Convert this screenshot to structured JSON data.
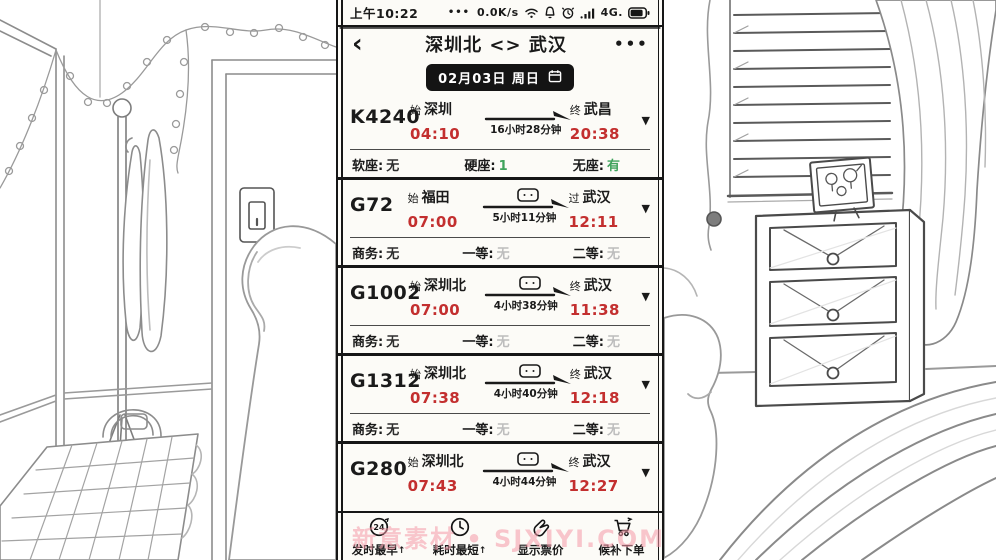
{
  "colors": {
    "ink": "#1a1a1a",
    "time_red": "#c32f2f",
    "available_green": "#3fa35c",
    "unavailable_gray": "#bdbdbd",
    "pill_black": "#141414",
    "watermark_pink": "#f59aa8"
  },
  "status_bar": {
    "time": "上午10:22",
    "dots": "•••",
    "net_speed": "0.0K/s",
    "icons": [
      "wifi",
      "bell",
      "alarm-clock",
      "signal-bars"
    ],
    "network": "4G.",
    "battery_icon": "battery"
  },
  "header": {
    "back_icon": "‹",
    "title": "深圳北 <> 武汉",
    "menu_icon": "•••"
  },
  "date_bar": {
    "date": "02月03日 周日",
    "calendar_icon": "calendar"
  },
  "trains": [
    {
      "code": "K4240",
      "from_tag": "始",
      "from": "深圳",
      "depart": "04:10",
      "duration": "16小时28分钟",
      "badge": false,
      "to_tag": "终",
      "to": "武昌",
      "arrive": "20:38",
      "seats": [
        {
          "label": "软座:",
          "value": "无",
          "color": "dark"
        },
        {
          "label": "硬座:",
          "value": "1",
          "color": "green"
        },
        {
          "label": "无座:",
          "value": "有",
          "color": "green"
        }
      ]
    },
    {
      "code": "G72",
      "from_tag": "始",
      "from": "福田",
      "depart": "07:00",
      "duration": "5小时11分钟",
      "badge": true,
      "to_tag": "过",
      "to": "武汉",
      "arrive": "12:11",
      "seats": [
        {
          "label": "商务:",
          "value": "无",
          "color": "dark"
        },
        {
          "label": "一等:",
          "value": "无",
          "color": "gray"
        },
        {
          "label": "二等:",
          "value": "无",
          "color": "gray"
        }
      ]
    },
    {
      "code": "G1002",
      "from_tag": "始",
      "from": "深圳北",
      "depart": "07:00",
      "duration": "4小时38分钟",
      "badge": true,
      "to_tag": "终",
      "to": "武汉",
      "arrive": "11:38",
      "seats": [
        {
          "label": "商务:",
          "value": "无",
          "color": "dark"
        },
        {
          "label": "一等:",
          "value": "无",
          "color": "gray"
        },
        {
          "label": "二等:",
          "value": "无",
          "color": "gray"
        }
      ]
    },
    {
      "code": "G1312",
      "from_tag": "始",
      "from": "深圳北",
      "depart": "07:38",
      "duration": "4小时40分钟",
      "badge": true,
      "to_tag": "终",
      "to": "武汉",
      "arrive": "12:18",
      "seats": [
        {
          "label": "商务:",
          "value": "无",
          "color": "dark"
        },
        {
          "label": "一等:",
          "value": "无",
          "color": "gray"
        },
        {
          "label": "二等:",
          "value": "无",
          "color": "gray"
        }
      ]
    },
    {
      "code": "G280",
      "from_tag": "始",
      "from": "深圳北",
      "depart": "07:43",
      "duration": "4小时44分钟",
      "badge": true,
      "to_tag": "终",
      "to": "武汉",
      "arrive": "12:27",
      "seats": []
    }
  ],
  "toolbar": {
    "items": [
      {
        "icon": "sort-24",
        "icon_text": "24",
        "label": "发时最早",
        "sort_marker": "↑"
      },
      {
        "icon": "clock",
        "label": "耗时最短",
        "sort_marker": "↑"
      },
      {
        "icon": "hand-price",
        "label": "显示票价"
      },
      {
        "icon": "cart",
        "label": "候补下单"
      }
    ]
  },
  "watermark": "新意素材 • SJXIYI.COM",
  "scene": {
    "left": [
      "window-frame",
      "string-lights",
      "coat-rack",
      "hanging-clothes",
      "door-frame",
      "light-switch",
      "reaching-finger",
      "checkered-table",
      "bag"
    ],
    "right": [
      "window-blinds",
      "curtain",
      "photo-frame",
      "family-photo-doodle",
      "dresser-with-drawers",
      "bed-blanket",
      "thumb-finger"
    ]
  }
}
